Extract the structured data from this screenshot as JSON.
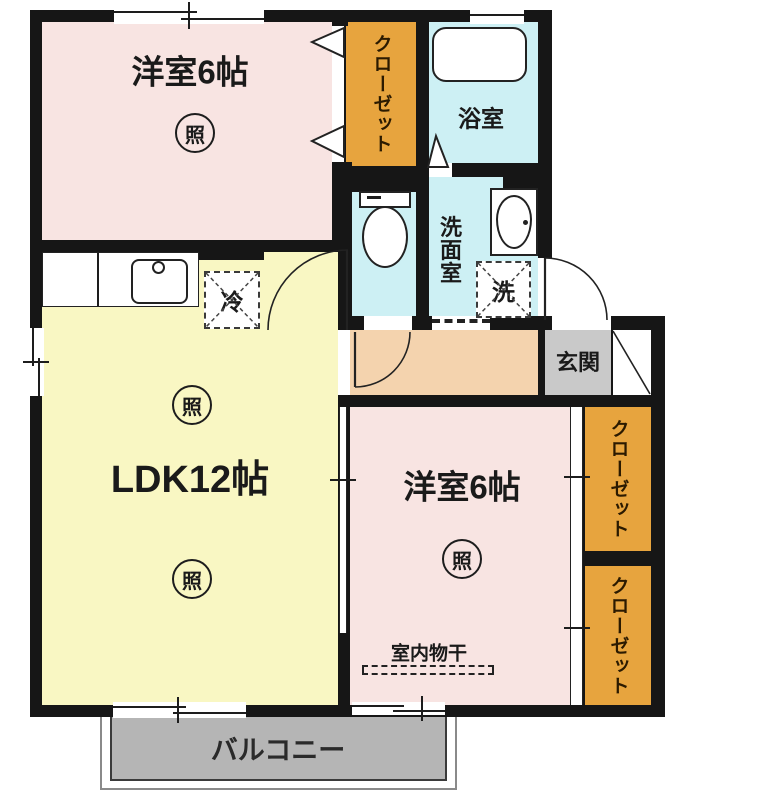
{
  "rooms": {
    "bedroom_top": {
      "label": "洋室6帖",
      "light": "照"
    },
    "closet_top": {
      "label": "クローゼット"
    },
    "bath": {
      "label": "浴室"
    },
    "washroom": {
      "label": "洗面室"
    },
    "washer": {
      "label": "洗"
    },
    "fridge": {
      "label": "冷"
    },
    "ldk": {
      "label": "LDK12帖",
      "light_upper": "照",
      "light_lower": "照"
    },
    "entrance": {
      "label": "玄関"
    },
    "bedroom_right": {
      "label": "洋室6帖",
      "light": "照"
    },
    "indoor_drying": {
      "label": "室内物干"
    },
    "closet_right_upper": {
      "label": "クローゼット"
    },
    "closet_right_lower": {
      "label": "クローゼット"
    },
    "balcony": {
      "label": "バルコニー"
    }
  },
  "colors": {
    "room_pink": "#f8e4e2",
    "ldk_yellow": "#f9f7c3",
    "wet_cyan": "#cdf0f4",
    "closet_orange": "#e7a43e",
    "hall_peach": "#f4d3ae",
    "entrance_gray": "#c9c9c9",
    "balcony_gray": "#b5b5b5",
    "wall_black": "#161616"
  }
}
